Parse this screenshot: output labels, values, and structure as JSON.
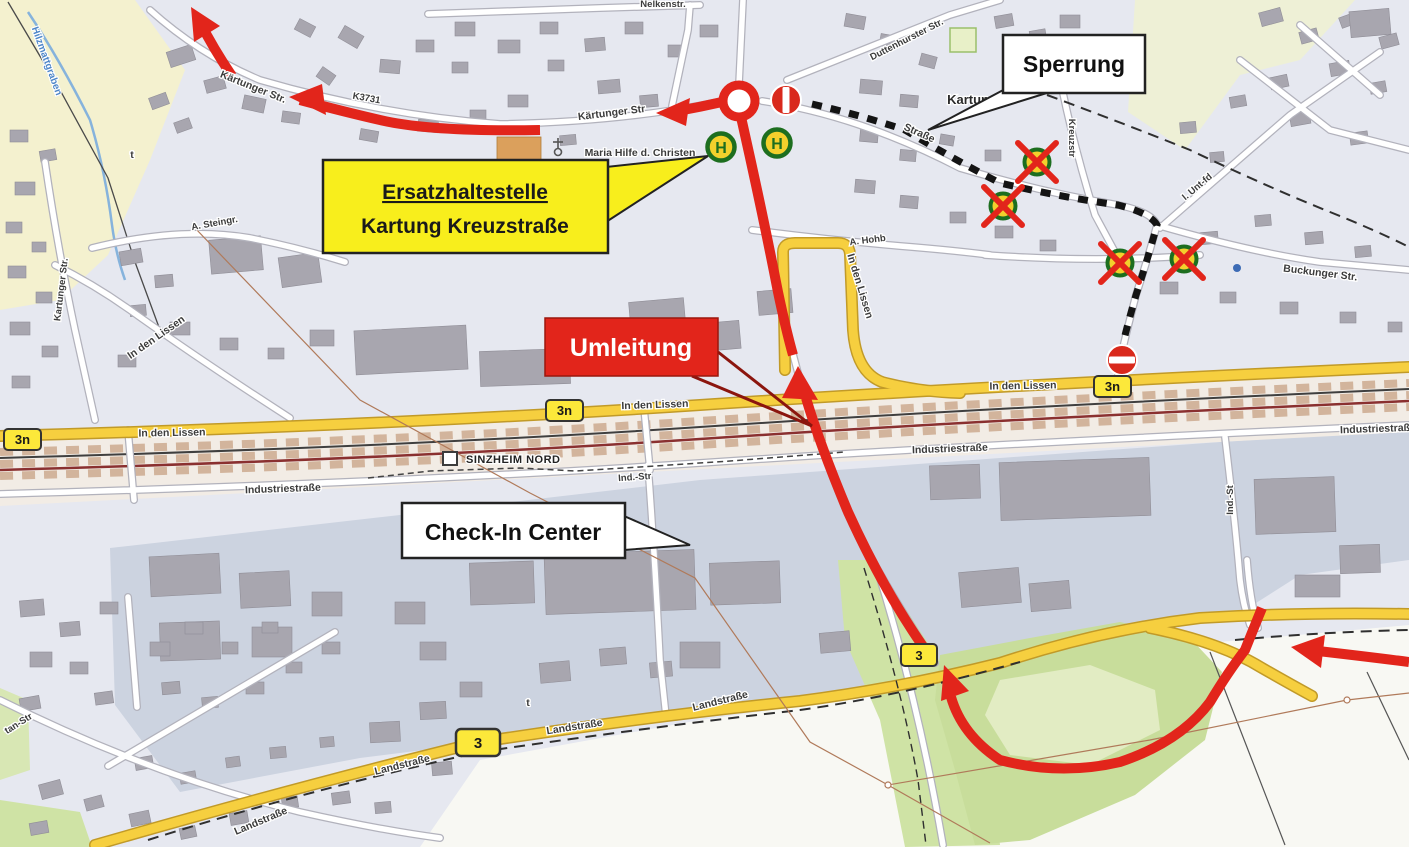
{
  "map": {
    "callouts": {
      "sperrung": "Sperrung",
      "umleitung": "Umleitung",
      "ersatzhaltestelle_line1": "Ersatzhaltestelle",
      "ersatzhaltestelle_line2": "Kartung Kreuzstraße",
      "check_in_center": "Check-In Center"
    },
    "station_name": "SINZHEIM NORD",
    "bus_stop_letter": "H",
    "road_badges": [
      {
        "label": "3n"
      },
      {
        "label": "3n"
      },
      {
        "label": "3n"
      },
      {
        "label": "3"
      },
      {
        "label": "3"
      }
    ],
    "street_labels": [
      {
        "text": "Kärtunger Str."
      },
      {
        "text": "K3731"
      },
      {
        "text": "Kärtunger Str"
      },
      {
        "text": "Nelkenstr."
      },
      {
        "text": "Duttenhurster Str."
      },
      {
        "text": "Straße"
      },
      {
        "text": "Kreuzstr"
      },
      {
        "text": "I. Unt-fd"
      },
      {
        "text": "Buckunger Str."
      },
      {
        "text": "A. Hohb"
      },
      {
        "text": "In den Lissen"
      },
      {
        "text": "A. Steingr."
      },
      {
        "text": "Kartunger Str."
      },
      {
        "text": "In den Lissen"
      },
      {
        "text": "In den Lissen"
      },
      {
        "text": "In den Lissen"
      },
      {
        "text": "In den Lissen"
      },
      {
        "text": "Industriestraße"
      },
      {
        "text": "Ind.-Str"
      },
      {
        "text": "Industriestraße"
      },
      {
        "text": "Ind.-St"
      },
      {
        "text": "Industriestraße"
      },
      {
        "text": "Landstraße"
      },
      {
        "text": "Landstraße"
      },
      {
        "text": "Landstraße"
      },
      {
        "text": "Landstraße"
      },
      {
        "text": "tan-Str"
      }
    ],
    "poi_labels": [
      {
        "text": "Maria Hilfe d. Christen"
      }
    ],
    "place_labels": [
      {
        "text": "Kartung"
      }
    ],
    "water_labels": [
      {
        "text": "Hilzmattgraben"
      }
    ],
    "symbol_glyphs": [
      {
        "text": "t"
      },
      {
        "text": "t"
      }
    ],
    "colors": {
      "detour_red": "#e2251b",
      "closure_black": "#141414",
      "replacement_stop_yellow": "#f8ee1c",
      "main_road_yellow": "#f6cf3f",
      "bus_stop_green": "#1d6e1f",
      "bus_stop_fill": "#f3d02c",
      "no_entry_red": "#d9291c",
      "building_gray": "#a8a6af",
      "industrial_zone": "#ccd3e0",
      "green_area": "#cfe3a5"
    }
  }
}
